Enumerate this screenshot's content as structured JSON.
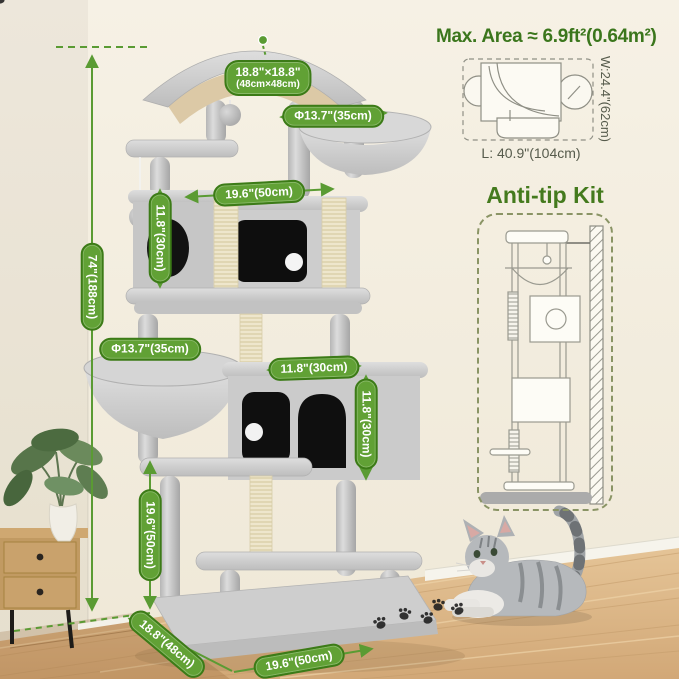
{
  "labels": {
    "max_area": "Max. Area ≈ 6.9ft²(0.64m²)",
    "length": "L: 40.9\"(104cm)",
    "width": "W:24.4\"(62cm)",
    "anti_tip": "Anti-tip Kit"
  },
  "dimensions": {
    "total_height": "74\"(188cm)",
    "top_platform_l1": "18.8\"×18.8\"",
    "top_platform_l2": "(48cm×48cm)",
    "top_basket_diameter": "Φ13.7\"(35cm)",
    "middle_width": "19.6\"(50cm)",
    "middle_condo_height": "11.8\"(30cm)",
    "lower_basket_diameter": "Φ13.7\"(35cm)",
    "lower_condo_depth": "11.8\"(30cm)",
    "lower_condo_height": "11.8\"(30cm)",
    "lower_height": "19.6\"(50cm)",
    "base_depth": "18.8\"(48cm)",
    "base_width": "19.6\"(50cm)"
  },
  "colors": {
    "accent_green": "#5a9b33",
    "pill_border": "#3c7b17",
    "heading_green": "#447a1d",
    "wall": "#f4efe2",
    "floor_wood": "#ddb88c",
    "plush_gray": "#cccccc",
    "sisal": "#ece4cb"
  }
}
